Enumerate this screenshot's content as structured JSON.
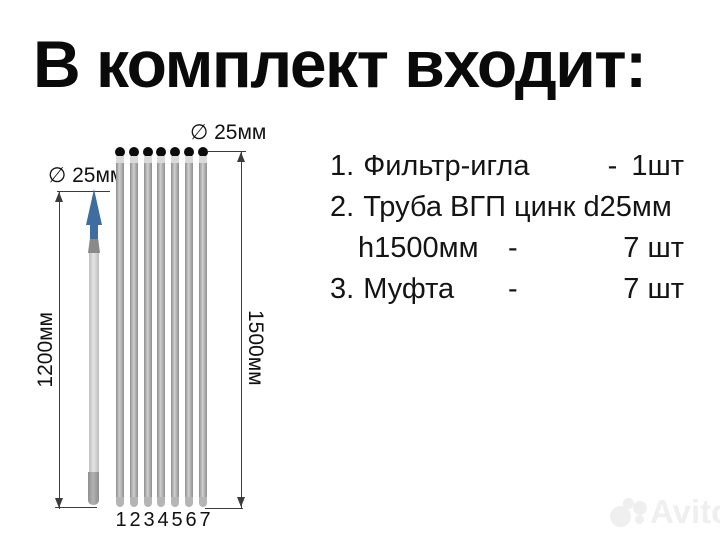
{
  "title": "В комплект входит:",
  "list": {
    "items": [
      {
        "num": "1.",
        "name": "Фильтр-игла",
        "dash": "-",
        "qty": "1шт"
      },
      {
        "num": "2.",
        "name": "Труба ВГП цинк d25мм",
        "cont": "h1500мм",
        "dash": "-",
        "qty": "7 шт"
      },
      {
        "num": "3.",
        "name": "Муфта",
        "dash": "-",
        "qty": "7 шт"
      }
    ]
  },
  "diagram": {
    "filter_needle": {
      "dia_label": "∅ 25мм",
      "height_label": "1200мм"
    },
    "pipe_group": {
      "dia_label": "∅ 25мм",
      "height_label": "1500мм",
      "pipe_count": 7,
      "numbers": [
        "1",
        "2",
        "3",
        "4",
        "5",
        "6",
        "7"
      ]
    },
    "colors": {
      "arrow_blue": "#3f6da0",
      "pipe_gray": "#8e8e8e",
      "pipe_highlight": "#cfcfcf",
      "cap_black": "#0c0c0c",
      "dim_line": "#3c3c3c"
    }
  },
  "watermark": {
    "text": "Avito",
    "color": "#efefef"
  }
}
